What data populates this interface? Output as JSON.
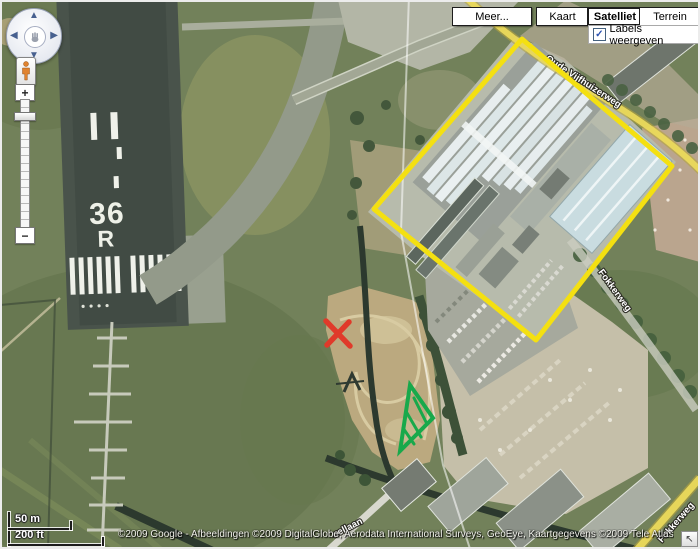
{
  "toolbar": {
    "meer_label": "Meer...",
    "kaart_label": "Kaart",
    "satelliet_label": "Satelliet",
    "terrein_label": "Terrein",
    "selected_view": "Satelliet",
    "labels_checkbox_label": "Labels weergeven",
    "labels_checkbox_checked": true
  },
  "icons": {
    "check": "✓",
    "collapse_arrow": "↖",
    "pan_up": "▲",
    "pan_down": "▼",
    "pan_left": "◀",
    "pan_right": "▶",
    "zoom_in": "+",
    "zoom_out": "−"
  },
  "scale_bar": {
    "metric": "50 m",
    "imperial": "200 ft"
  },
  "attribution": {
    "text": "©2009 Google - Afbeeldingen ©2009 DigitalGlobe, Aerodata International Surveys, GeoEye, Kaartgegevens ©2009 Tele Atlas - ",
    "terms_link": "gebruiksvoorwaarden"
  },
  "map_labels": {
    "runway_number": "36",
    "runway_letter": "R",
    "street_top_right": "Oude Vijfhuizerweg",
    "street_right": "Fokkerweg",
    "street_bottom_right": "Fokkerweg",
    "street_bottom_center": "uellaan"
  },
  "annotations": {
    "rectangle_color": "#f4e011",
    "x_color": "#e03a2a",
    "triangle_color": "#18a94b"
  }
}
